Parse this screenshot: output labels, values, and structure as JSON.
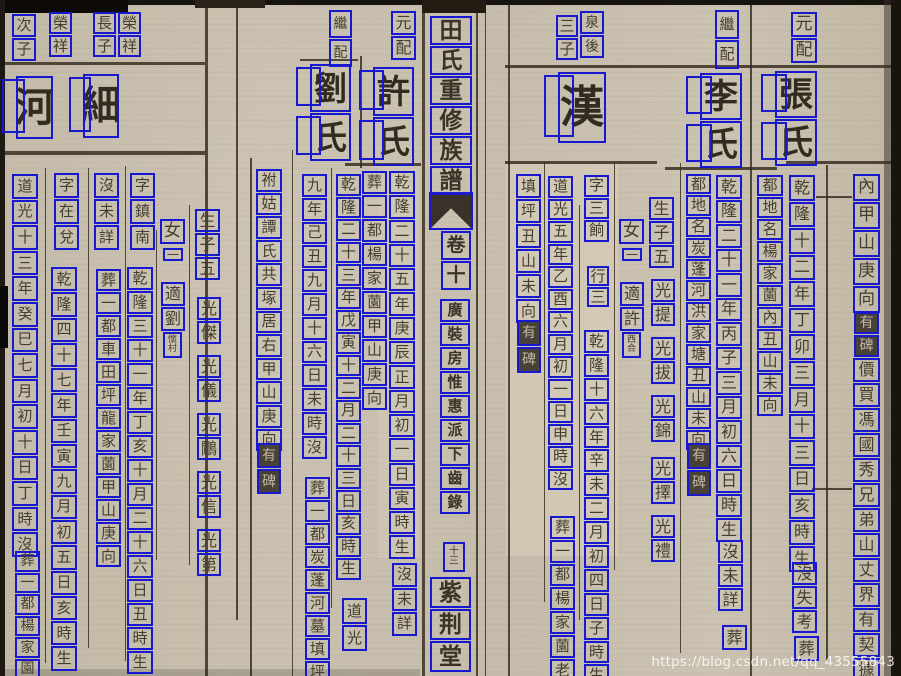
{
  "watermark": "https://blog.csdn.net/qq_43555843",
  "colors": {
    "ocr_box_blue": "#1818d0",
    "paper": "#c7bdac",
    "ink": "#453d31",
    "dark_note_bg": "#48413a",
    "dark_note_ink": "#c3b8a0",
    "rule_line": "#3a3122"
  },
  "spine": {
    "title": "田氏重修族譜",
    "volume": "卷十",
    "section": "廣裝房惟惠派下齒錄",
    "folio": "十三",
    "hall": "紫荆堂"
  },
  "ocr_columns": [
    {
      "name": "right-margin-geomancy",
      "x": 853,
      "y": 174,
      "w": 27,
      "cell": 27,
      "size": 17,
      "text": "內甲山庚向"
    },
    {
      "name": "right-margin-tablet-note",
      "x": 854,
      "y": 312,
      "w": 25,
      "cell": 22,
      "size": 14,
      "text": "有碑",
      "style": "dark"
    },
    {
      "name": "right-margin-deed-note",
      "x": 853,
      "y": 358,
      "w": 27,
      "cell": 24,
      "size": 16,
      "text": "價買馮國秀兄弟山丈界有契據"
    },
    {
      "name": "zhang-label",
      "x": 791,
      "y": 12,
      "w": 26,
      "cell": 25,
      "size": 17,
      "text": "元配"
    },
    {
      "name": "zhang-name",
      "x": 775,
      "y": 71,
      "w": 42,
      "cell": 47,
      "size": 34,
      "text": "張氏",
      "style": "large",
      "ghost": true
    },
    {
      "name": "zhang-birth",
      "x": 789,
      "y": 175,
      "w": 26,
      "cell": 25.5,
      "size": 16,
      "text": "乾隆十二年丁卯三月十三日亥時生"
    },
    {
      "name": "zhang-death",
      "x": 792,
      "y": 562,
      "w": 25,
      "cell": 23,
      "size": 16,
      "text": "沒失考"
    },
    {
      "name": "zhang-burial",
      "x": 794,
      "y": 636,
      "w": 25,
      "cell": 25,
      "size": 16,
      "text": "葬"
    },
    {
      "name": "zhang-grave-site",
      "x": 757,
      "y": 175,
      "w": 26,
      "cell": 21,
      "size": 15,
      "text": "都地名楊家薗內丑山未向"
    },
    {
      "name": "li-label",
      "x": 715,
      "y": 10,
      "w": 24,
      "cell": 29,
      "size": 15,
      "text": "繼配"
    },
    {
      "name": "li-name",
      "x": 700,
      "y": 73,
      "w": 42,
      "cell": 47,
      "size": 34,
      "text": "李氏",
      "style": "large",
      "ghost": true
    },
    {
      "name": "li-birth",
      "x": 716,
      "y": 175,
      "w": 26,
      "cell": 23.5,
      "size": 16,
      "text": "乾隆二十一年丙子三月初六日時生"
    },
    {
      "name": "li-death",
      "x": 718,
      "y": 540,
      "w": 25,
      "cell": 23,
      "size": 16,
      "text": "沒未詳"
    },
    {
      "name": "li-burial",
      "x": 722,
      "y": 625,
      "w": 25,
      "cell": 25,
      "size": 16,
      "text": "葬"
    },
    {
      "name": "li-grave-site",
      "x": 686,
      "y": 174,
      "w": 25,
      "cell": 20.3,
      "size": 15,
      "text": "都地名炭蓬河洪家塘丑山未向"
    },
    {
      "name": "li-tablet-note",
      "x": 687,
      "y": 443,
      "w": 24,
      "cell": 26,
      "size": 14,
      "text": "有碑",
      "style": "dark"
    },
    {
      "name": "sons-count-right",
      "x": 649,
      "y": 197,
      "w": 25,
      "cell": 23,
      "size": 16,
      "text": "生子五"
    },
    {
      "name": "son-guangti",
      "x": 651,
      "y": 279,
      "w": 24,
      "cell": 23,
      "size": 16,
      "text": "光提"
    },
    {
      "name": "son-guangba",
      "x": 651,
      "y": 337,
      "w": 24,
      "cell": 23,
      "size": 16,
      "text": "光拔"
    },
    {
      "name": "son-guangjin",
      "x": 651,
      "y": 395,
      "w": 24,
      "cell": 23,
      "size": 16,
      "text": "光錦"
    },
    {
      "name": "son-guangze",
      "x": 651,
      "y": 457,
      "w": 24,
      "cell": 23,
      "size": 16,
      "text": "光擇"
    },
    {
      "name": "son-guangli",
      "x": 651,
      "y": 515,
      "w": 24,
      "cell": 23,
      "size": 16,
      "text": "光禮"
    },
    {
      "name": "daughter-right",
      "x": 619,
      "y": 219,
      "w": 25,
      "cell": 25,
      "size": 17,
      "text": "女"
    },
    {
      "name": "daughter-right-one",
      "x": 622,
      "y": 248,
      "w": 20,
      "cell": 13,
      "size": 12,
      "text": "一"
    },
    {
      "name": "daughter-right-married",
      "x": 620,
      "y": 282,
      "w": 24,
      "cell": 24,
      "size": 16,
      "text": "適許"
    },
    {
      "name": "daughter-right-husband",
      "x": 622,
      "y": 332,
      "w": 19,
      "cell": 26,
      "size": 9,
      "text": "西合",
      "style": "stack"
    },
    {
      "name": "han-father",
      "x": 580,
      "y": 11,
      "w": 24,
      "cell": 23,
      "size": 14,
      "text": "泉後"
    },
    {
      "name": "han-rank",
      "x": 556,
      "y": 15,
      "w": 22,
      "cell": 22,
      "size": 15,
      "text": "三子"
    },
    {
      "name": "han-name",
      "x": 558,
      "y": 72,
      "w": 48,
      "cell": 71,
      "size": 44,
      "text": "漢",
      "style": "large",
      "ghost": true
    },
    {
      "name": "han-courtesy",
      "x": 584,
      "y": 175,
      "w": 25,
      "cell": 21.5,
      "size": 15,
      "text": "字三餉"
    },
    {
      "name": "han-order",
      "x": 587,
      "y": 266,
      "w": 22,
      "cell": 20,
      "size": 15,
      "text": "行三"
    },
    {
      "name": "han-birth",
      "x": 584,
      "y": 330,
      "w": 25,
      "cell": 22.9,
      "size": 15,
      "text": "乾隆十六年辛未二月初四日子時生"
    },
    {
      "name": "han-death",
      "x": 548,
      "y": 176,
      "w": 25,
      "cell": 21.5,
      "size": 15,
      "text": "道光五年乙酉六月初一日申時沒"
    },
    {
      "name": "han-burial",
      "x": 550,
      "y": 516,
      "w": 25,
      "cell": 22.8,
      "size": 15,
      "text": "葬一都楊家薗老"
    },
    {
      "name": "han-grave-site",
      "x": 516,
      "y": 174,
      "w": 25,
      "cell": 24,
      "size": 15,
      "text": "填坪丑山未向"
    },
    {
      "name": "han-tablet-note",
      "x": 517,
      "y": 320,
      "w": 24,
      "cell": 26,
      "size": 14,
      "text": "有碑",
      "style": "dark"
    },
    {
      "name": "spine-title",
      "x": 430,
      "y": 16,
      "w": 42,
      "cell": 29,
      "size": 23,
      "text": "田氏重修族譜",
      "style": "spine"
    },
    {
      "name": "spine-volume",
      "x": 441,
      "y": 231,
      "w": 30,
      "cell": 29,
      "size": 19,
      "text": "卷十",
      "style": "spine"
    },
    {
      "name": "spine-section",
      "x": 440,
      "y": 299,
      "w": 30,
      "cell": 23,
      "size": 15,
      "text": "廣裝房惟惠派下齒錄",
      "style": "spine"
    },
    {
      "name": "spine-folio",
      "x": 443,
      "y": 542,
      "w": 22,
      "cell": 30,
      "size": 10,
      "text": "十三",
      "style": "stack"
    },
    {
      "name": "spine-hall",
      "x": 430,
      "y": 577,
      "w": 41,
      "cell": 31,
      "size": 23,
      "text": "紫荆堂",
      "style": "spine"
    },
    {
      "name": "ci-rank",
      "x": 12,
      "y": 14,
      "w": 24,
      "cell": 23,
      "size": 15,
      "text": "次子"
    },
    {
      "name": "ci-father",
      "x": 49,
      "y": 12,
      "w": 23,
      "cell": 22,
      "size": 15,
      "text": "榮祥"
    },
    {
      "name": "chang-rank",
      "x": 93,
      "y": 12,
      "w": 23,
      "cell": 22,
      "size": 15,
      "text": "長子"
    },
    {
      "name": "chang-father",
      "x": 118,
      "y": 12,
      "w": 23,
      "cell": 22,
      "size": 15,
      "text": "榮祥"
    },
    {
      "name": "he-name",
      "x": 16,
      "y": 76,
      "w": 37,
      "cell": 63,
      "size": 40,
      "text": "河",
      "style": "large",
      "ghost": true
    },
    {
      "name": "he-death",
      "x": 12,
      "y": 174,
      "w": 26,
      "cell": 24.6,
      "size": 15,
      "text": "道光十三年癸巳七月初十日丁時沒"
    },
    {
      "name": "he-burial",
      "x": 15,
      "y": 551,
      "w": 25,
      "cell": 20.6,
      "size": 14,
      "text": "葬一都楊家園"
    },
    {
      "name": "xi-name",
      "x": 83,
      "y": 74,
      "w": 36,
      "cell": 64,
      "size": 40,
      "text": "細",
      "style": "large",
      "ghost": true
    },
    {
      "name": "xi-courtesy",
      "x": 54,
      "y": 173,
      "w": 25,
      "cell": 25,
      "size": 15,
      "text": "字在兌"
    },
    {
      "name": "xi-birth",
      "x": 51,
      "y": 267,
      "w": 26,
      "cell": 24.3,
      "size": 15,
      "text": "乾隆四十七年壬寅九月初五日亥時生"
    },
    {
      "name": "xi-death",
      "x": 94,
      "y": 173,
      "w": 25,
      "cell": 25,
      "size": 15,
      "text": "沒未詳"
    },
    {
      "name": "xi-burial",
      "x": 96,
      "y": 269,
      "w": 25,
      "cell": 22,
      "size": 15,
      "text": "葬一都車田坪龍家薗甲山庚向"
    },
    {
      "name": "xi-courtesy2",
      "x": 130,
      "y": 173,
      "w": 25,
      "cell": 25,
      "size": 15,
      "text": "字鎮南"
    },
    {
      "name": "xi-birth2",
      "x": 127,
      "y": 267,
      "w": 26,
      "cell": 23,
      "size": 15,
      "text": "乾隆三十一年丁亥十月二十六日丑時生"
    },
    {
      "name": "daughter-left",
      "x": 160,
      "y": 219,
      "w": 25,
      "cell": 25,
      "size": 17,
      "text": "女"
    },
    {
      "name": "daughter-left-one",
      "x": 163,
      "y": 248,
      "w": 20,
      "cell": 13,
      "size": 12,
      "text": "一"
    },
    {
      "name": "daughter-left-married",
      "x": 161,
      "y": 282,
      "w": 24,
      "cell": 24,
      "size": 16,
      "text": "適劉"
    },
    {
      "name": "daughter-left-husband",
      "x": 163,
      "y": 332,
      "w": 19,
      "cell": 26,
      "size": 9,
      "text": "懷村",
      "style": "stack"
    },
    {
      "name": "sons-count-left",
      "x": 195,
      "y": 209,
      "w": 25,
      "cell": 23,
      "size": 16,
      "text": "生子五"
    },
    {
      "name": "son-guangjie",
      "x": 197,
      "y": 297,
      "w": 24,
      "cell": 23,
      "size": 16,
      "text": "光傑"
    },
    {
      "name": "son-guangyi",
      "x": 197,
      "y": 355,
      "w": 24,
      "cell": 23,
      "size": 16,
      "text": "光儀"
    },
    {
      "name": "son-guanghan",
      "x": 197,
      "y": 413,
      "w": 24,
      "cell": 23,
      "size": 16,
      "text": "光鷳"
    },
    {
      "name": "son-guangxin",
      "x": 197,
      "y": 471,
      "w": 24,
      "cell": 23,
      "size": 16,
      "text": "光信"
    },
    {
      "name": "son-guangdi",
      "x": 197,
      "y": 529,
      "w": 24,
      "cell": 23,
      "size": 16,
      "text": "光第"
    },
    {
      "name": "liu-label",
      "x": 329,
      "y": 10,
      "w": 23,
      "cell": 28,
      "size": 14,
      "text": "繼配"
    },
    {
      "name": "liu-name",
      "x": 310,
      "y": 64,
      "w": 41,
      "cell": 48,
      "size": 33,
      "text": "劉氏",
      "style": "large",
      "ghost": true
    },
    {
      "name": "liu-birth",
      "x": 336,
      "y": 174,
      "w": 25,
      "cell": 21.6,
      "size": 15,
      "text": "乾隆二十三年戊寅十二月二十三日亥時生"
    },
    {
      "name": "liu-death-era",
      "x": 342,
      "y": 598,
      "w": 25,
      "cell": 26,
      "size": 15,
      "text": "道光"
    },
    {
      "name": "liu-death",
      "x": 302,
      "y": 174,
      "w": 25,
      "cell": 22.8,
      "size": 15,
      "text": "九年己丑九月十六日未時沒"
    },
    {
      "name": "liu-burial",
      "x": 305,
      "y": 477,
      "w": 25,
      "cell": 22,
      "size": 15,
      "text": "葬一都炭蓬河墓填坪"
    },
    {
      "name": "liu-joint-grave",
      "x": 256,
      "y": 169,
      "w": 26,
      "cell": 22.6,
      "size": 15,
      "text": "祔姑譚氏共塚居右甲山庚向"
    },
    {
      "name": "liu-tablet-note",
      "x": 257,
      "y": 443,
      "w": 24,
      "cell": 25,
      "size": 14,
      "text": "有碑",
      "style": "dark"
    },
    {
      "name": "xu-label",
      "x": 391,
      "y": 11,
      "w": 25,
      "cell": 24,
      "size": 16,
      "text": "元配"
    },
    {
      "name": "xu-name",
      "x": 373,
      "y": 67,
      "w": 41,
      "cell": 49,
      "size": 33,
      "text": "許氏",
      "style": "large",
      "ghost": true
    },
    {
      "name": "xu-birth",
      "x": 389,
      "y": 171,
      "w": 26,
      "cell": 23.3,
      "size": 15,
      "text": "乾隆二十五年庚辰正月初一日寅時生"
    },
    {
      "name": "xu-death",
      "x": 392,
      "y": 563,
      "w": 25,
      "cell": 23.5,
      "size": 15,
      "text": "沒未詳"
    },
    {
      "name": "xu-burial",
      "x": 362,
      "y": 171,
      "w": 25,
      "cell": 23,
      "size": 15,
      "text": "葬一都楊家薗甲山庚向"
    }
  ]
}
